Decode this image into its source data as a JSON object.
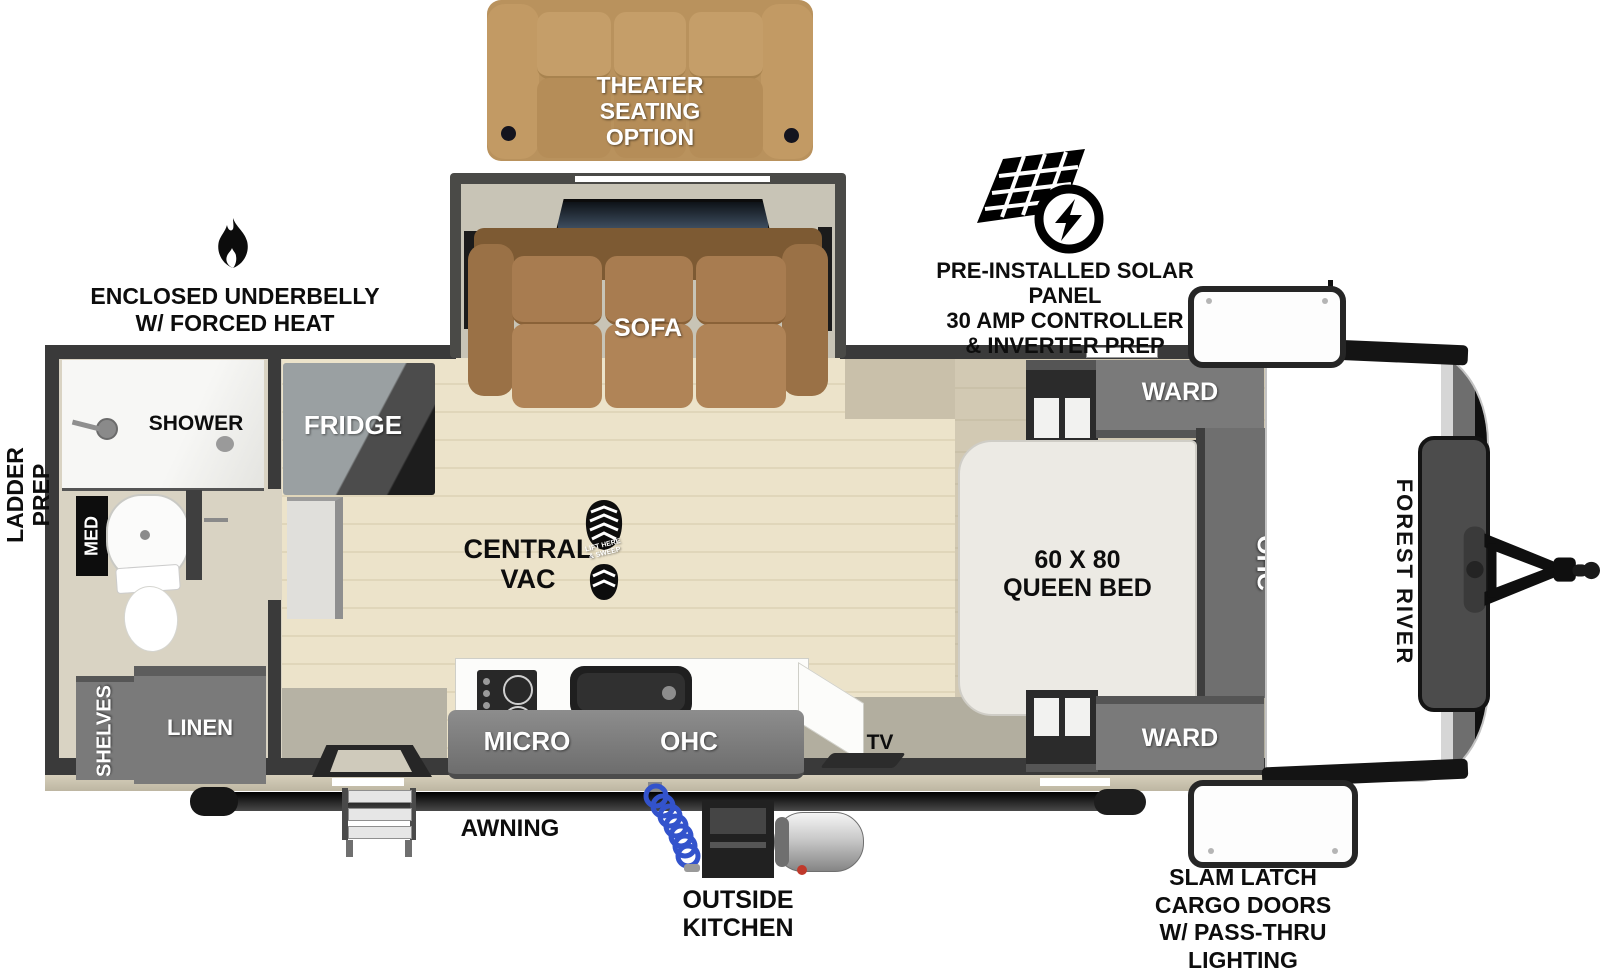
{
  "colors": {
    "wall": "#3a3a3a",
    "cabinet_gray": "#7a7a7a",
    "sofa_brown": "#a87c4e",
    "theater_tan": "#bb955f",
    "wood_floor": "#ece3ca",
    "rear_floor": "#d9d3c3",
    "bedroom_floor": "#d2c9b3",
    "bed_white": "#eceae4",
    "hose_blue": "#3353cc",
    "callout_text": "#0d0d0d"
  },
  "brand": {
    "front_cap_label": "FOREST RIVER"
  },
  "callouts": {
    "theater_seating": {
      "lines": [
        "THEATER",
        "SEATING",
        "OPTION"
      ]
    },
    "solar": {
      "lines": [
        "PRE-INSTALLED SOLAR PANEL",
        "30 AMP CONTROLLER",
        "& INVERTER PREP"
      ]
    },
    "underbelly": {
      "lines": [
        "ENCLOSED UNDERBELLY",
        "W/ FORCED HEAT"
      ]
    },
    "ladder_prep": {
      "lines": [
        "LADDER",
        "PREP"
      ]
    },
    "central_vac": {
      "lines": [
        "CENTRAL",
        "VAC"
      ]
    },
    "vac_boot": {
      "lines": [
        "LIFT HERE",
        "& SWEEP"
      ]
    },
    "awning": {
      "label": "AWNING"
    },
    "outside_kitchen": {
      "lines": [
        "OUTSIDE",
        "KITCHEN"
      ]
    },
    "cargo_doors": {
      "lines": [
        "SLAM LATCH",
        "CARGO DOORS",
        "W/ PASS-THRU",
        "LIGHTING"
      ]
    }
  },
  "labels": {
    "sofa": "SOFA",
    "fridge": "FRIDGE",
    "shower": "SHOWER",
    "med": "MED",
    "shelves": "SHELVES",
    "linen": "LINEN",
    "micro": "MICRO",
    "kitchen_ohc": "OHC",
    "tv": "TV",
    "bed_line1": "60 X 80",
    "bed_line2": "QUEEN BED",
    "ward_top": "WARD",
    "ward_bottom": "WARD",
    "bedroom_ohc": "OHC"
  }
}
